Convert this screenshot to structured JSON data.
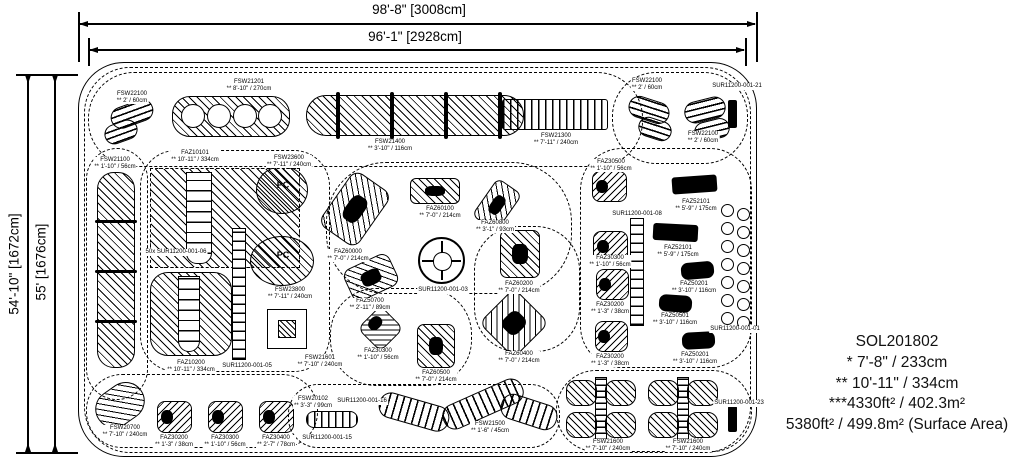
{
  "dimensions": {
    "top_outer": "98'-8\" [3008cm]",
    "top_inner": "96'-1\" [2928cm]",
    "left_outer": "54'-10\" [1672cm]",
    "left_inner": "55' [1676cm]"
  },
  "info_block": {
    "lines": [
      "SOL201802",
      "* 7'-8\" / 233cm",
      "** 10'-11\" / 334cm",
      "***4330ft² / 402.3m²",
      "5380ft² / 499.8m² (Surface Area)"
    ]
  },
  "plan": {
    "clouds": [
      {
        "x": 84,
        "y": 67,
        "w": 667,
        "h": 386,
        "rx": 46
      },
      {
        "x": 88,
        "y": 72,
        "w": 555,
        "h": 95,
        "rx": 46
      },
      {
        "x": 612,
        "y": 72,
        "w": 136,
        "h": 92,
        "rx": 44
      },
      {
        "x": 86,
        "y": 148,
        "w": 62,
        "h": 252,
        "rx": 31
      },
      {
        "x": 140,
        "y": 150,
        "w": 190,
        "h": 222,
        "rx": 36
      },
      {
        "x": 326,
        "y": 162,
        "w": 246,
        "h": 132,
        "rx": 60
      },
      {
        "x": 330,
        "y": 288,
        "w": 142,
        "h": 98,
        "rx": 46
      },
      {
        "x": 580,
        "y": 148,
        "w": 172,
        "h": 220,
        "rx": 42
      },
      {
        "x": 86,
        "y": 374,
        "w": 232,
        "h": 74,
        "rx": 36
      },
      {
        "x": 288,
        "y": 384,
        "w": 272,
        "h": 64,
        "rx": 30
      },
      {
        "x": 556,
        "y": 370,
        "w": 196,
        "h": 82,
        "rx": 40
      },
      {
        "x": 474,
        "y": 226,
        "w": 106,
        "h": 126,
        "rx": 44
      }
    ],
    "shapes": [
      {
        "n": "fsw22100-steps",
        "t": "hstripes",
        "x": 110,
        "y": 103,
        "w": 44,
        "h": 22,
        "rot": -20,
        "rx": 11
      },
      {
        "n": "fsw22100-steps",
        "t": "hstripes",
        "x": 104,
        "y": 122,
        "w": 34,
        "h": 20,
        "rot": -20,
        "rx": 10
      },
      {
        "n": "fsw21201-balance-beam",
        "t": "hatch",
        "x": 172,
        "y": 96,
        "w": 118,
        "h": 41,
        "rx": 18
      },
      {
        "n": "ring",
        "t": "ring",
        "x": 181,
        "y": 104,
        "w": 24,
        "h": 24
      },
      {
        "n": "ring",
        "t": "ring",
        "x": 207,
        "y": 104,
        "w": 24,
        "h": 24
      },
      {
        "n": "ring",
        "t": "ring",
        "x": 233,
        "y": 104,
        "w": 24,
        "h": 24
      },
      {
        "n": "ring",
        "t": "ring",
        "x": 258,
        "y": 104,
        "w": 24,
        "h": 24
      },
      {
        "n": "fsw21400-balance-beam",
        "t": "hatch",
        "x": 306,
        "y": 95,
        "w": 218,
        "h": 41,
        "rx": 20
      },
      {
        "n": "beam-post",
        "t": "blackbar",
        "x": 336,
        "y": 92,
        "w": 4,
        "h": 47
      },
      {
        "n": "beam-post",
        "t": "blackbar",
        "x": 390,
        "y": 92,
        "w": 4,
        "h": 47
      },
      {
        "n": "beam-post",
        "t": "blackbar",
        "x": 444,
        "y": 92,
        "w": 4,
        "h": 47
      },
      {
        "n": "beam-post",
        "t": "blackbar",
        "x": 498,
        "y": 92,
        "w": 4,
        "h": 47
      },
      {
        "n": "fsw21300-bridge",
        "t": "vstripes",
        "x": 502,
        "y": 99,
        "w": 106,
        "h": 31,
        "rx": 3
      },
      {
        "n": "fsw22100-steps",
        "t": "hstripes",
        "x": 628,
        "y": 99,
        "w": 42,
        "h": 22,
        "rot": 18,
        "rx": 11
      },
      {
        "n": "fsw22100-steps",
        "t": "hstripes",
        "x": 638,
        "y": 119,
        "w": 34,
        "h": 20,
        "rot": 18,
        "rx": 10
      },
      {
        "n": "fsw22100-steps",
        "t": "hstripes",
        "x": 684,
        "y": 99,
        "w": 42,
        "h": 22,
        "rot": -14,
        "rx": 11
      },
      {
        "n": "fsw22100-steps",
        "t": "hstripes",
        "x": 694,
        "y": 120,
        "w": 36,
        "h": 20,
        "rot": -14,
        "rx": 10
      },
      {
        "n": "sign-post",
        "t": "blackbar",
        "x": 728,
        "y": 100,
        "w": 9,
        "h": 28
      },
      {
        "n": "fsw21100-climb-wall",
        "t": "hatch",
        "x": 97,
        "y": 172,
        "w": 38,
        "h": 196,
        "rx": 17
      },
      {
        "n": "wall-divider",
        "t": "blackbar",
        "x": 95,
        "y": 220,
        "w": 42,
        "h": 3
      },
      {
        "n": "wall-divider",
        "t": "blackbar",
        "x": 95,
        "y": 270,
        "w": 42,
        "h": 3
      },
      {
        "n": "wall-divider",
        "t": "blackbar",
        "x": 95,
        "y": 320,
        "w": 42,
        "h": 3
      },
      {
        "n": "faz10101-slide-zone",
        "t": "dashed-box",
        "x": 150,
        "y": 168,
        "w": 150,
        "h": 100
      },
      {
        "n": "faz10101-slide",
        "t": "tower",
        "x": 186,
        "y": 172,
        "w": 26,
        "h": 92
      },
      {
        "n": "access-ladder",
        "t": "ladder",
        "x": 232,
        "y": 228,
        "w": 14,
        "h": 132
      },
      {
        "n": "faz10200-slide-zone",
        "t": "hatch",
        "x": 150,
        "y": 272,
        "w": 82,
        "h": 84,
        "rx": 18
      },
      {
        "n": "faz10200-slide",
        "t": "tower",
        "x": 178,
        "y": 276,
        "w": 22,
        "h": 76
      },
      {
        "n": "fsw23600-panel",
        "t": "circle-hatch",
        "x": 256,
        "y": 166,
        "w": 52,
        "h": 48
      },
      {
        "n": "fsw23800-panel",
        "t": "circle-hatch",
        "x": 250,
        "y": 236,
        "w": 64,
        "h": 50
      },
      {
        "n": "fsw21601-deck",
        "t": "sq-in-sq",
        "x": 256,
        "y": 298,
        "w": 60,
        "h": 60
      },
      {
        "n": "faz60000-rider",
        "t": "hatch",
        "x": 332,
        "y": 176,
        "w": 46,
        "h": 66,
        "rot": 35,
        "rx": 10,
        "blob": 1
      },
      {
        "n": "faz60100-rider",
        "t": "hatch",
        "x": 410,
        "y": 178,
        "w": 50,
        "h": 26,
        "rx": 6,
        "blob": 1
      },
      {
        "n": "faz60800-rider",
        "t": "hatch",
        "x": 482,
        "y": 182,
        "w": 30,
        "h": 46,
        "rot": 35,
        "rx": 7,
        "blob": 1
      },
      {
        "n": "faz30500-spring-toy",
        "t": "rsq",
        "x": 592,
        "y": 171,
        "w": 35,
        "h": 31
      },
      {
        "n": "faz52101-seesaw",
        "t": "darkrect",
        "x": 672,
        "y": 176,
        "w": 45,
        "h": 17,
        "rot": -4
      },
      {
        "n": "faz52101-seesaw",
        "t": "darkrect",
        "x": 653,
        "y": 224,
        "w": 45,
        "h": 17,
        "rot": 3
      },
      {
        "n": "faz30300-spring-toy",
        "t": "rsq",
        "x": 593,
        "y": 231,
        "w": 35,
        "h": 31
      },
      {
        "n": "access-ladder",
        "t": "ladder",
        "x": 630,
        "y": 218,
        "w": 14,
        "h": 108
      },
      {
        "n": "faz30200-spring-toy",
        "t": "rsq",
        "x": 596,
        "y": 269,
        "w": 33,
        "h": 31
      },
      {
        "n": "faz30200-spring-toy",
        "t": "rsq",
        "x": 595,
        "y": 321,
        "w": 33,
        "h": 31
      },
      {
        "n": "faz50201-play-car",
        "t": "car",
        "x": 681,
        "y": 262,
        "w": 33,
        "h": 17,
        "rot": -5
      },
      {
        "n": "faz50501-play-car",
        "t": "car",
        "x": 659,
        "y": 295,
        "w": 33,
        "h": 17,
        "rot": 4
      },
      {
        "n": "faz50201-play-car",
        "t": "car",
        "x": 682,
        "y": 332,
        "w": 33,
        "h": 17,
        "rot": -3
      },
      {
        "n": "sur11200-001-03-spinner",
        "t": "spinner",
        "x": 418,
        "y": 237,
        "w": 47,
        "h": 47
      },
      {
        "n": "faz60200-rider",
        "t": "hatch",
        "x": 500,
        "y": 230,
        "w": 40,
        "h": 48,
        "rx": 7,
        "blob": 1
      },
      {
        "n": "faz50700-rider",
        "t": "hatch",
        "x": 346,
        "y": 260,
        "w": 50,
        "h": 35,
        "rot": -25,
        "rx": 9,
        "blob": 1
      },
      {
        "n": "faz30300-spring-toy",
        "t": "rsq",
        "x": 364,
        "y": 312,
        "w": 33,
        "h": 33,
        "rot": 45
      },
      {
        "n": "faz60500-rider",
        "t": "hatch",
        "x": 417,
        "y": 324,
        "w": 38,
        "h": 44,
        "rx": 7,
        "blob": 1
      },
      {
        "n": "faz60400-rider",
        "t": "hatch",
        "x": 489,
        "y": 298,
        "w": 50,
        "h": 50,
        "rot": 45,
        "rx": 9,
        "blob": 1
      },
      {
        "n": "stepper-pods",
        "t": "barbells",
        "x": 721,
        "y": 204,
        "w": 31,
        "h": 128,
        "rows": 7
      },
      {
        "n": "fsw20700-steps",
        "t": "hatch",
        "x": 94,
        "y": 386,
        "w": 52,
        "h": 38,
        "rot": -35,
        "rx": 19
      },
      {
        "n": "faz30200-spring-toy",
        "t": "rsq",
        "x": 157,
        "y": 401,
        "w": 35,
        "h": 32
      },
      {
        "n": "faz30300-spring-toy",
        "t": "rsq",
        "x": 208,
        "y": 401,
        "w": 35,
        "h": 32
      },
      {
        "n": "faz30400-spring-toy",
        "t": "rsq",
        "x": 259,
        "y": 401,
        "w": 35,
        "h": 32
      },
      {
        "n": "fsw20102-bench",
        "t": "vstripes",
        "x": 306,
        "y": 411,
        "w": 52,
        "h": 17,
        "rx": 8
      },
      {
        "n": "fsw21500-balance-path",
        "t": "vstripes",
        "x": 378,
        "y": 399,
        "w": 72,
        "h": 26,
        "rot": 16,
        "rx": 12
      },
      {
        "n": "fsw21500-balance-path",
        "t": "vstripes",
        "x": 440,
        "y": 391,
        "w": 86,
        "h": 26,
        "rot": -24,
        "rx": 12
      },
      {
        "n": "fsw21500-balance-path",
        "t": "vstripes",
        "x": 500,
        "y": 399,
        "w": 58,
        "h": 26,
        "rot": 18,
        "rx": 12
      },
      {
        "n": "fsw21600-climber",
        "t": "butterfly",
        "x": 566,
        "y": 380,
        "w": 70,
        "h": 58
      },
      {
        "n": "fsw21600-climber",
        "t": "butterfly",
        "x": 648,
        "y": 380,
        "w": 70,
        "h": 58
      },
      {
        "n": "sign-post",
        "t": "blackbar",
        "x": 728,
        "y": 406,
        "w": 9,
        "h": 26
      }
    ],
    "labels": [
      {
        "cx": 132,
        "y": 91,
        "lines": [
          "FSW22100",
          "** 2' / 60cm"
        ]
      },
      {
        "cx": 249,
        "y": 79,
        "lines": [
          "FSW21201",
          "** 8'-10\" / 270cm"
        ]
      },
      {
        "cx": 390,
        "y": 139,
        "lines": [
          "FSW21400",
          "** 3'-10\" / 116cm"
        ]
      },
      {
        "cx": 556,
        "y": 133,
        "lines": [
          "FSW21300",
          "** 7'-11\" / 240cm"
        ]
      },
      {
        "cx": 647,
        "y": 78,
        "lines": [
          "FSW22100",
          "** 2' / 60cm"
        ]
      },
      {
        "cx": 703,
        "y": 131,
        "lines": [
          "FSW22100",
          "** 2' / 60cm"
        ]
      },
      {
        "cx": 737,
        "y": 83,
        "lines": [
          "SUR11200-001-21"
        ]
      },
      {
        "cx": 115,
        "y": 157,
        "lines": [
          "FSW21100",
          "** 1'-10\" / 56cm"
        ]
      },
      {
        "cx": 195,
        "y": 150,
        "lines": [
          "FAZ10101",
          "** 10'-11\" / 334cm"
        ]
      },
      {
        "cx": 289,
        "y": 155,
        "lines": [
          "FSW23600",
          "** 7'-11\" / 240cm"
        ]
      },
      {
        "cx": 176,
        "y": 249,
        "lines": [
          "50x SUR11200-001-06"
        ]
      },
      {
        "cx": 348,
        "y": 249,
        "lines": [
          "FAZ60000",
          "** 7'-0\" / 214cm"
        ]
      },
      {
        "cx": 440,
        "y": 206,
        "lines": [
          "FAZ60100",
          "** 7'-0\" / 214cm"
        ]
      },
      {
        "cx": 495,
        "y": 220,
        "lines": [
          "FAZ60800",
          "** 3'-1\" / 93cm"
        ]
      },
      {
        "cx": 611,
        "y": 159,
        "lines": [
          "FAZ30500",
          "** 1'-10\" / 56cm"
        ]
      },
      {
        "cx": 696,
        "y": 199,
        "lines": [
          "FAZ52101",
          "** 5'-9\" / 175cm"
        ]
      },
      {
        "cx": 637,
        "y": 211,
        "lines": [
          "SUR11200-001-08"
        ]
      },
      {
        "cx": 678,
        "y": 245,
        "lines": [
          "FAZ52101",
          "** 5'-9\" / 175cm"
        ]
      },
      {
        "cx": 610,
        "y": 255,
        "lines": [
          "FAZ30300",
          "** 1'-10\" / 56cm"
        ]
      },
      {
        "cx": 443,
        "y": 287,
        "lines": [
          "SUR11200-001-03"
        ]
      },
      {
        "cx": 519,
        "y": 281,
        "lines": [
          "FAZ60200",
          "** 7'-0\" / 214cm"
        ]
      },
      {
        "cx": 370,
        "y": 298,
        "lines": [
          "FAZ50700",
          "** 2'-11\" / 89cm"
        ]
      },
      {
        "cx": 290,
        "y": 287,
        "lines": [
          "FSW23800",
          "** 7'-11\" / 240cm"
        ]
      },
      {
        "cx": 610,
        "y": 302,
        "lines": [
          "FAZ30200",
          "** 1'-3\" / 38cm"
        ]
      },
      {
        "cx": 694,
        "y": 281,
        "lines": [
          "FAZ50201",
          "** 3'-10\" / 116cm"
        ]
      },
      {
        "cx": 675,
        "y": 313,
        "lines": [
          "FAZ50501",
          "** 3'-10\" / 116cm"
        ]
      },
      {
        "cx": 735,
        "y": 326,
        "lines": [
          "SUR11200-001-01"
        ]
      },
      {
        "cx": 378,
        "y": 348,
        "lines": [
          "FAZ30300",
          "** 1'-10\" / 56cm"
        ]
      },
      {
        "cx": 436,
        "y": 370,
        "lines": [
          "FAZ60500",
          "** 7'-0\" / 214cm"
        ]
      },
      {
        "cx": 519,
        "y": 351,
        "lines": [
          "FAZ60400",
          "** 7'-0\" / 214cm"
        ]
      },
      {
        "cx": 610,
        "y": 354,
        "lines": [
          "FAZ30200",
          "** 1'-3\" / 38cm"
        ]
      },
      {
        "cx": 695,
        "y": 352,
        "lines": [
          "FAZ50201",
          "** 3'-10\" / 116cm"
        ]
      },
      {
        "cx": 320,
        "y": 355,
        "lines": [
          "FSW21601",
          "** 7'-10\" / 240cm"
        ]
      },
      {
        "cx": 191,
        "y": 360,
        "lines": [
          "FAZ10200",
          "** 10'-11\" / 334cm"
        ]
      },
      {
        "cx": 247,
        "y": 363,
        "lines": [
          "SUR11200-001-05"
        ]
      },
      {
        "cx": 125,
        "y": 425,
        "lines": [
          "FSW20700",
          "** 7'-10\" / 240cm"
        ]
      },
      {
        "cx": 174,
        "y": 435,
        "lines": [
          "FAZ30200",
          "** 1'-3\" / 38cm"
        ]
      },
      {
        "cx": 225,
        "y": 435,
        "lines": [
          "FAZ30300",
          "** 1'-10\" / 56cm"
        ]
      },
      {
        "cx": 276,
        "y": 435,
        "lines": [
          "FAZ30400",
          "** 2'-7\" / 78cm"
        ]
      },
      {
        "cx": 313,
        "y": 396,
        "lines": [
          "FSW20102",
          "** 3'-3\" / 99cm"
        ]
      },
      {
        "cx": 362,
        "y": 398,
        "lines": [
          "SUR11200-001-16"
        ]
      },
      {
        "cx": 327,
        "y": 435,
        "lines": [
          "SUR11200-001-15"
        ]
      },
      {
        "cx": 490,
        "y": 421,
        "lines": [
          "FSW21500",
          "** 1'-6\" / 45cm"
        ]
      },
      {
        "cx": 608,
        "y": 439,
        "lines": [
          "FSW21600",
          "** 7'-10\" / 240cm"
        ]
      },
      {
        "cx": 688,
        "y": 439,
        "lines": [
          "FSW21600",
          "** 7'-10\" / 240cm"
        ]
      },
      {
        "cx": 739,
        "y": 400,
        "lines": [
          "SUR11200-001-23"
        ]
      },
      {
        "cx": 283,
        "y": 182,
        "lines": [
          "PC"
        ],
        "fs": 9
      },
      {
        "cx": 283,
        "y": 252,
        "lines": [
          "PC"
        ],
        "fs": 9
      }
    ]
  }
}
